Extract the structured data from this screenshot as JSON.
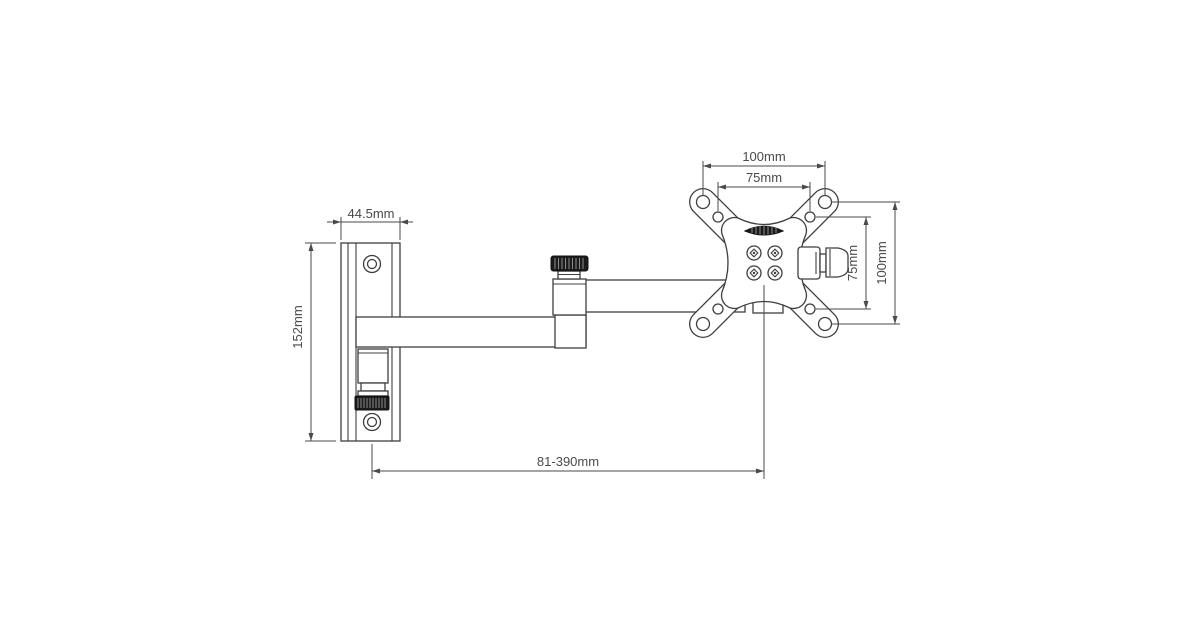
{
  "page": {
    "background": "#ffffff"
  },
  "drawing": {
    "subject": "articulating-monitor-wall-mount-technical-drawing",
    "line_color": "#3f3f3f",
    "dimension_color": "#4a4a4a",
    "labels": {
      "wall_plate_width": "44.5mm",
      "wall_plate_height": "152mm",
      "vesa_outer_width": "100mm",
      "vesa_inner_width": "75mm",
      "vesa_inner_height": "75mm",
      "vesa_outer_height": "100mm",
      "extension_range": "81-390mm"
    }
  }
}
